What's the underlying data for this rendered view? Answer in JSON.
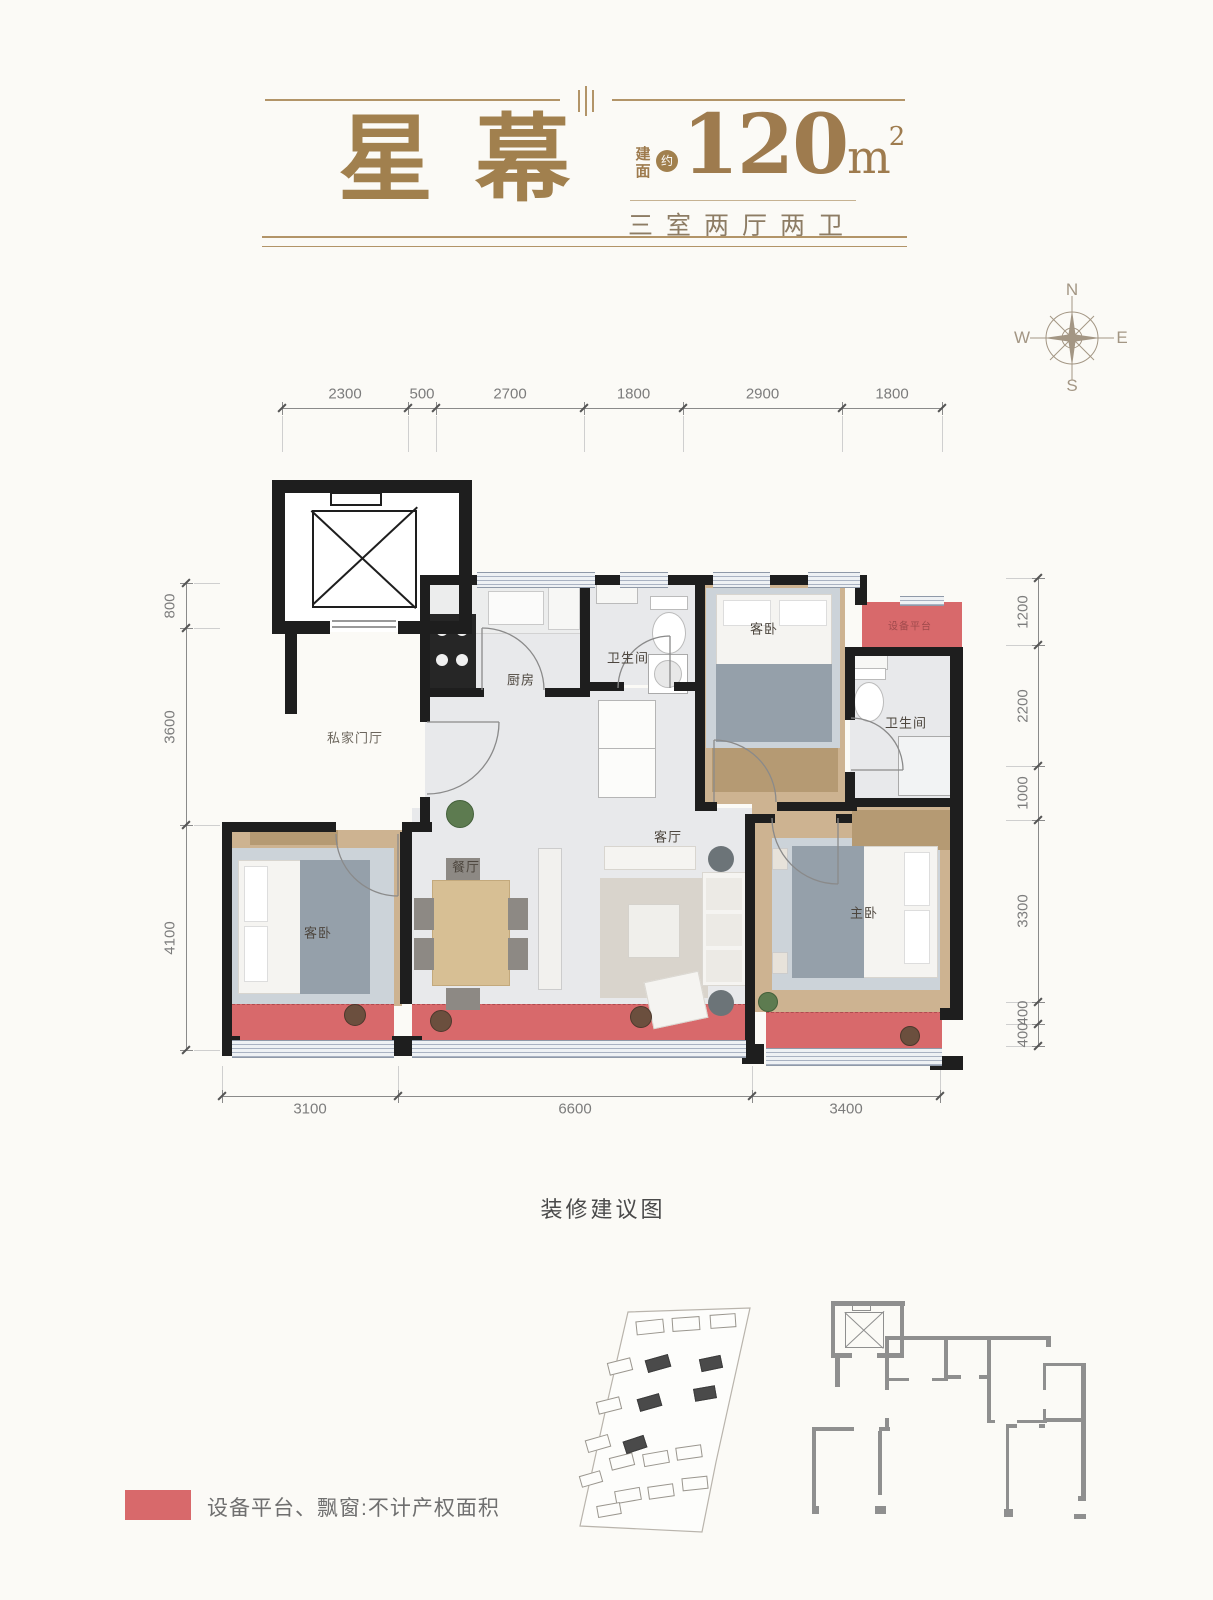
{
  "header": {
    "title": "星幕",
    "area_label_chars": [
      "建",
      "面"
    ],
    "area_approx": "约",
    "area_value": "120",
    "area_unit": "m",
    "area_exp": "2",
    "rooms_summary": "三室两厅两卫",
    "accent_color": "#a1804e"
  },
  "compass": {
    "north": "N",
    "east": "E",
    "south": "S",
    "west": "W"
  },
  "dimensions": {
    "top": [
      "2300",
      "500",
      "2700",
      "1800",
      "2900",
      "1800"
    ],
    "bottom": [
      "3100",
      "6600",
      "3400"
    ],
    "left": [
      "800",
      "3600",
      "4100"
    ],
    "right": [
      "1200",
      "2200",
      "1000",
      "3300",
      "400",
      "400"
    ]
  },
  "rooms": [
    {
      "name": "private-foyer",
      "label": "私家门厅",
      "x": 355,
      "y": 737,
      "size": 13,
      "color": "#6b655c"
    },
    {
      "name": "kitchen",
      "label": "厨房",
      "x": 521,
      "y": 679,
      "size": 13,
      "color": "#4d463e"
    },
    {
      "name": "bathroom-1",
      "label": "卫生间",
      "x": 628,
      "y": 657,
      "size": 13,
      "color": "#4d463e"
    },
    {
      "name": "guest-bedroom-north",
      "label": "客卧",
      "x": 764,
      "y": 628,
      "size": 13,
      "color": "#4d463e"
    },
    {
      "name": "equipment-platform",
      "label": "设备平台",
      "x": 910,
      "y": 625,
      "size": 10,
      "color": "#a04a4c"
    },
    {
      "name": "bathroom-2",
      "label": "卫生间",
      "x": 906,
      "y": 722,
      "size": 13,
      "color": "#4d463e"
    },
    {
      "name": "dining-room",
      "label": "餐厅",
      "x": 466,
      "y": 866,
      "size": 13,
      "color": "#4d463e"
    },
    {
      "name": "living-room",
      "label": "客厅",
      "x": 668,
      "y": 836,
      "size": 13,
      "color": "#4d463e"
    },
    {
      "name": "master-bedroom",
      "label": "主卧",
      "x": 864,
      "y": 912,
      "size": 13,
      "color": "#4d463e"
    },
    {
      "name": "guest-bedroom-west",
      "label": "客卧",
      "x": 318,
      "y": 932,
      "size": 13,
      "color": "#4d463e"
    }
  ],
  "caption": "装修建议图",
  "legend": {
    "swatch_color": "#d8696b",
    "text": "设备平台、飘窗:不计产权面积"
  },
  "site_plan": {
    "dark_buildings": [
      {
        "x": 646,
        "y": 1357,
        "w": 22,
        "h": 11,
        "r": -16
      },
      {
        "x": 700,
        "y": 1357,
        "w": 20,
        "h": 11,
        "r": -12
      },
      {
        "x": 638,
        "y": 1396,
        "w": 21,
        "h": 11,
        "r": -16
      },
      {
        "x": 694,
        "y": 1387,
        "w": 20,
        "h": 11,
        "r": -10
      },
      {
        "x": 624,
        "y": 1438,
        "w": 20,
        "h": 11,
        "r": -18
      }
    ],
    "outline_buildings": [
      {
        "x": 636,
        "y": 1320,
        "w": 26,
        "h": 12,
        "r": -6
      },
      {
        "x": 672,
        "y": 1317,
        "w": 26,
        "h": 12,
        "r": -4
      },
      {
        "x": 710,
        "y": 1314,
        "w": 24,
        "h": 12,
        "r": -4
      },
      {
        "x": 608,
        "y": 1360,
        "w": 22,
        "h": 11,
        "r": -14
      },
      {
        "x": 597,
        "y": 1399,
        "w": 22,
        "h": 11,
        "r": -14
      },
      {
        "x": 586,
        "y": 1437,
        "w": 22,
        "h": 11,
        "r": -16
      },
      {
        "x": 610,
        "y": 1455,
        "w": 22,
        "h": 11,
        "r": -14
      },
      {
        "x": 643,
        "y": 1452,
        "w": 24,
        "h": 11,
        "r": -10
      },
      {
        "x": 676,
        "y": 1446,
        "w": 24,
        "h": 11,
        "r": -8
      },
      {
        "x": 580,
        "y": 1473,
        "w": 20,
        "h": 10,
        "r": -16
      },
      {
        "x": 615,
        "y": 1489,
        "w": 24,
        "h": 11,
        "r": -10
      },
      {
        "x": 648,
        "y": 1485,
        "w": 24,
        "h": 11,
        "r": -8
      },
      {
        "x": 682,
        "y": 1477,
        "w": 24,
        "h": 11,
        "r": -6
      },
      {
        "x": 597,
        "y": 1504,
        "w": 22,
        "h": 10,
        "r": -10
      }
    ]
  }
}
